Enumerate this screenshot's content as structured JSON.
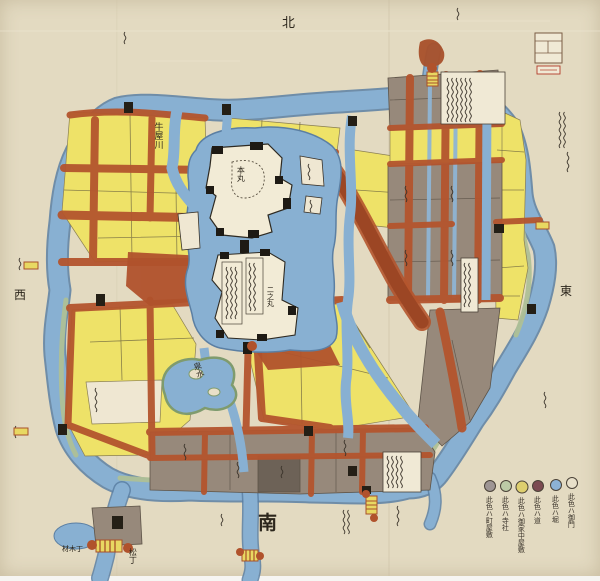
{
  "document": {
    "type": "hand-painted Edo-period Japanese castle town map (scanned sheet)",
    "orientation_note": "south edge labeled at bottom"
  },
  "compass": {
    "north": "北",
    "south": "南",
    "east": "東",
    "west": "西"
  },
  "map_labels": {
    "river": "牛屋川",
    "main_bailey": "本丸",
    "second_bailey": "二之丸",
    "pond": "泉水",
    "matsu_cho": "松丁",
    "zaimoku_cho": "材木丁"
  },
  "legend": {
    "items": [
      {
        "name": "townhouses",
        "color": "#9e9594",
        "label": "此色ハ町屋敷"
      },
      {
        "name": "temples-shrines",
        "color": "#bccaa6",
        "label": "此色ハ寺社"
      },
      {
        "name": "retainer-residences",
        "color": "#decf6f",
        "label": "此色ハ御家中屋敷"
      },
      {
        "name": "roads",
        "color": "#7c4b52",
        "label": "此色ハ道"
      },
      {
        "name": "moats-rivers",
        "color": "#8cb2d5",
        "label": "此色ハ堀"
      },
      {
        "name": "gates",
        "color": "#e8e0ca",
        "label": "此色ハ御門"
      }
    ]
  },
  "palette": {
    "paper": "#e3dac1",
    "moat_blue": "#88b0d2",
    "district_yellow": "#eee268",
    "street_red": "#b4552e",
    "district_gray": "#97897b",
    "temple_green": "#aec096",
    "ink": "#2c261c"
  }
}
